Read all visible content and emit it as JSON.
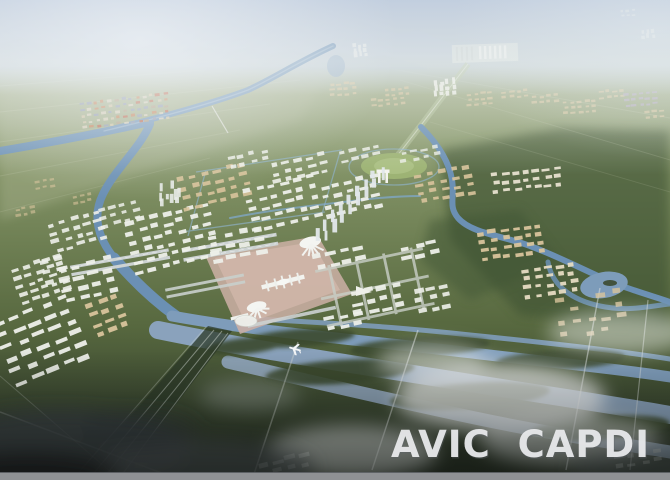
{
  "watermark": {
    "text": "AVIC CAPDI",
    "color": "#ebecee"
  },
  "palette": {
    "sky": "#b4c3d7",
    "haze": "#e9eef0",
    "mountain": "#a7b1ba",
    "plain": "#9aa883",
    "field": "#78885c",
    "forest": "#44533a",
    "river": "#6b90b4",
    "delta_water": "#8aa2bc",
    "apron": "#cdb0a6",
    "runway": "#ccd2d2",
    "building_white": "#eef0ea",
    "building_tan": "#d9c49c",
    "cbd_tower": "#e2e7ea",
    "foreground": "#232b21",
    "fog": "#f2f4f5",
    "bottom_bar": "#8f9194"
  }
}
